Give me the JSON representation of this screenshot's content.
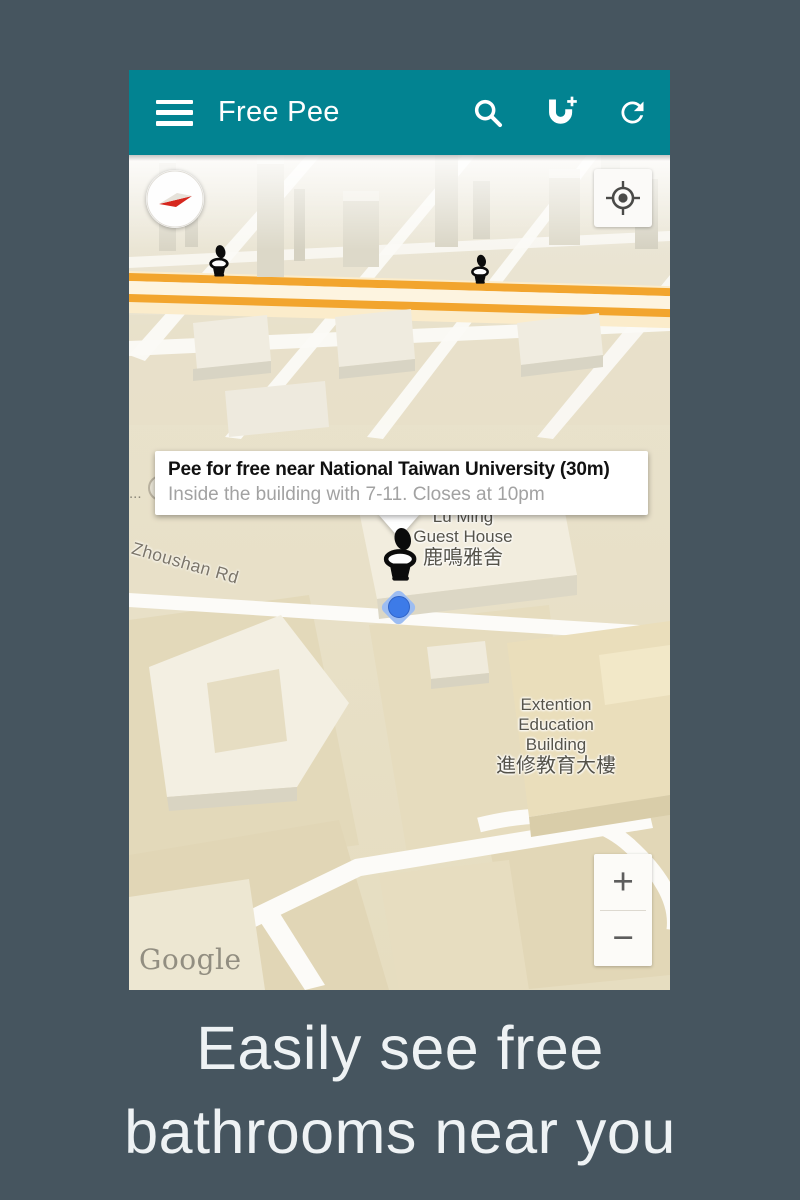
{
  "app": {
    "title": "Free Pee"
  },
  "map": {
    "info_window": {
      "title": "Pee for free near National Taiwan University (30m)",
      "subtitle": "Inside the building with 7-11. Closes at 10pm"
    },
    "labels": {
      "road": "Zhoushan Rd",
      "guest_house": [
        "Lu Ming",
        "Guest House",
        "鹿鳴雅舍"
      ],
      "extension_building": [
        "Extention",
        "Education",
        "Building",
        "進修教育大樓"
      ],
      "truncated": "...",
      "attribution": "Google"
    },
    "controls": {
      "zoom_in": "+",
      "zoom_out": "−"
    }
  },
  "caption": {
    "line1": "Easily see free",
    "line2": "bathrooms near you"
  },
  "colors": {
    "appbar_teal": "#028391",
    "page_background": "#46555f",
    "highway_orange": "#f2a52e",
    "location_blue": "#3d7be8",
    "map_ground": "#e8e0c6"
  }
}
